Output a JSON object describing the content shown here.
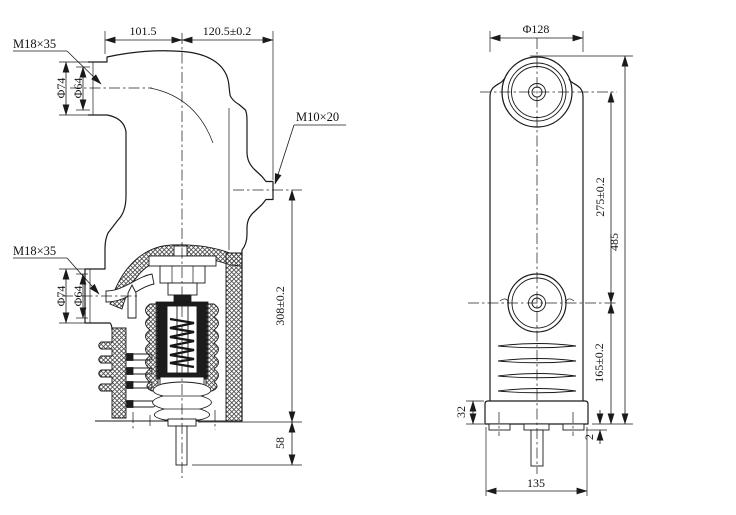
{
  "meta": {
    "description": "Two-view dimensioned engineering drawing of a vacuum circuit breaker embedded pole",
    "colors": {
      "ink": "#1a1a1a",
      "paper": "#ffffff"
    }
  },
  "side_view": {
    "name": "sectioned side view",
    "dims": {
      "width_left": "101.5",
      "width_right": "120.5±0.2",
      "upper_terminal_thread": "M18×35",
      "upper_terminal_od": "Φ74",
      "upper_terminal_id": "Φ64",
      "middle_stud_thread": "M10×20",
      "lower_terminal_thread": "M18×35",
      "lower_terminal_od": "Φ74",
      "lower_terminal_id": "Φ64",
      "stud_to_base_height": "308±0.2",
      "stem_length": "58"
    }
  },
  "front_view": {
    "name": "front view",
    "dims": {
      "boss_diameter": "Φ128",
      "terminal_centers_distance": "275±0.2",
      "overall_height": "485",
      "lower_terminal_to_base": "165±0.2",
      "base_height": "32",
      "foot_height": "2",
      "base_width": "135"
    }
  }
}
